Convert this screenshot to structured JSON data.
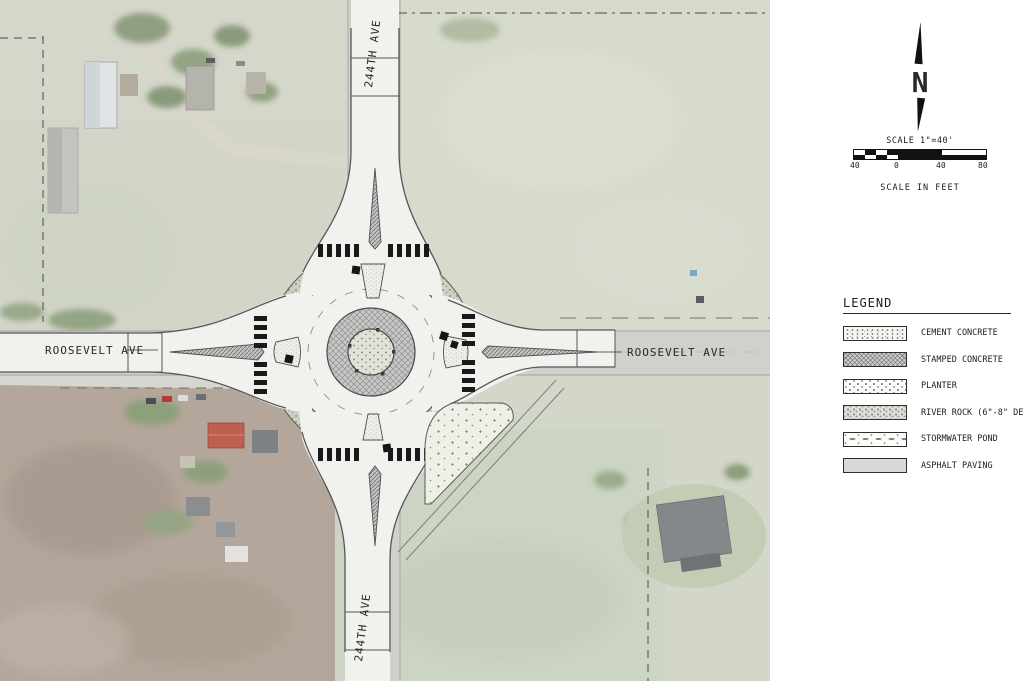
{
  "map": {
    "road_labels": {
      "roosevelt_west": "ROOSEVELT AVE",
      "roosevelt_east": "ROOSEVELT AVE",
      "ave244_north": "244TH AVE",
      "ave244_south": "244TH AVE"
    }
  },
  "north_arrow": {
    "letter": "N"
  },
  "scale": {
    "title": "SCALE 1\"=40'",
    "labels": [
      "40",
      "0",
      "40",
      "80"
    ],
    "caption": "SCALE IN FEET"
  },
  "legend": {
    "title": "LEGEND",
    "items": [
      {
        "label": "CEMENT CONCRETE",
        "pattern": "cement-concrete"
      },
      {
        "label": "STAMPED CONCRETE",
        "pattern": "stamped-concrete"
      },
      {
        "label": "PLANTER",
        "pattern": "planter"
      },
      {
        "label": "RIVER ROCK (6\"-8\" DEPTH)",
        "pattern": "river-rock"
      },
      {
        "label": "STORMWATER POND",
        "pattern": "stormwater-pond"
      },
      {
        "label": "ASPHALT PAVING",
        "pattern": "asphalt-paving"
      }
    ]
  },
  "colors": {
    "plan_line": "#54575a",
    "pavement": "#f1f1ee",
    "crosswalk": "#1a1a1a",
    "aerial_field_green": "#d3d7ca",
    "aerial_field_brown": "#b4a69a"
  }
}
